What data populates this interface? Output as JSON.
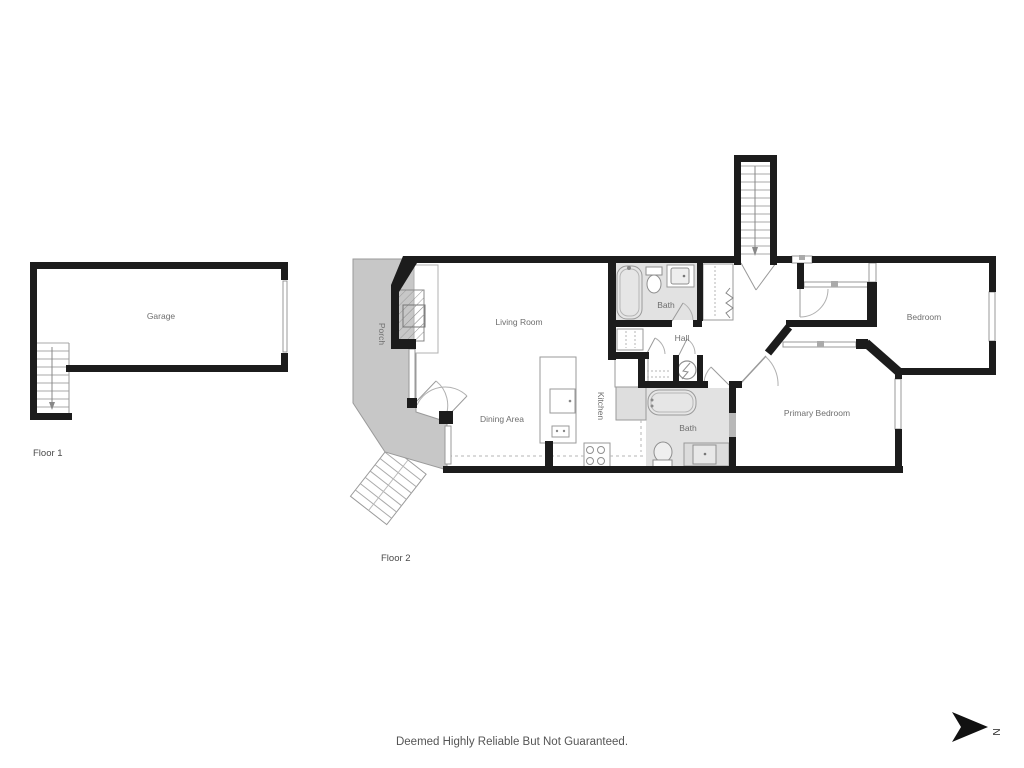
{
  "floor1": {
    "label": "Floor 1",
    "rooms": {
      "garage": "Garage"
    }
  },
  "floor2": {
    "label": "Floor 2",
    "rooms": {
      "porch": "Porch",
      "living_room": "Living Room",
      "dining_area": "Dining Area",
      "kitchen": "Kitchen",
      "bath_upper": "Bath",
      "hall": "Hall",
      "bath_lower": "Bath",
      "bedroom": "Bedroom",
      "primary_bedroom": "Primary Bedroom"
    }
  },
  "footer": {
    "disclaimer": "Deemed Highly Reliable But Not Guaranteed."
  },
  "compass": {
    "north_label": "N"
  },
  "colors": {
    "wall": "#1c1c1c",
    "porch_fill": "#c7c7c7",
    "bath_fill": "#e2e2e2",
    "label_text": "#6e6e6e",
    "thin_line": "#9a9a9a"
  }
}
